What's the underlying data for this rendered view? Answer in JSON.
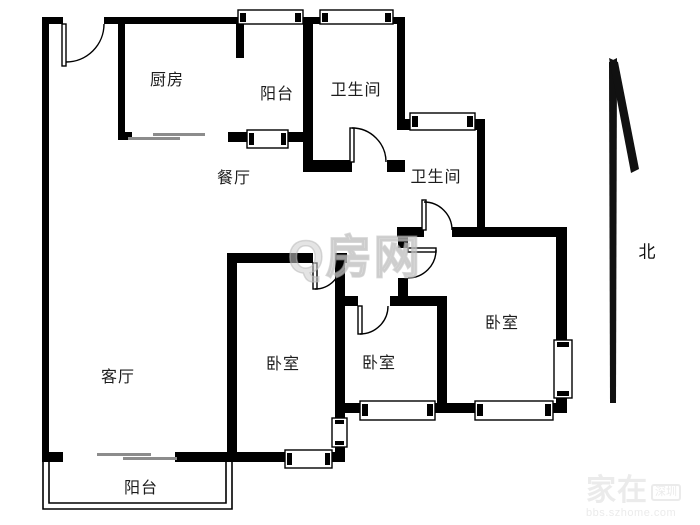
{
  "plan": {
    "rooms": {
      "kitchen": {
        "label": "厨房"
      },
      "balcony_top": {
        "label": "阳台"
      },
      "bath_top": {
        "label": "卫生间"
      },
      "dining": {
        "label": "餐厅"
      },
      "bath_inner": {
        "label": "卫生间"
      },
      "living": {
        "label": "客厅"
      },
      "bed_left": {
        "label": "卧室"
      },
      "bed_middle": {
        "label": "卧室"
      },
      "bed_right": {
        "label": "卧室"
      },
      "balcony_bottom": {
        "label": "阳台"
      }
    },
    "compass": {
      "label": "北"
    },
    "watermarks": {
      "center": "Q房网",
      "corner_brand": "家在",
      "corner_badge": "深圳",
      "corner_site": "bbs.szhome.com"
    },
    "colors": {
      "wall": "#000000",
      "sliding_door": "#8c8c8c",
      "background": "#ffffff",
      "label_text": "#1c1c1c",
      "watermark": "#cdcdcd"
    }
  }
}
